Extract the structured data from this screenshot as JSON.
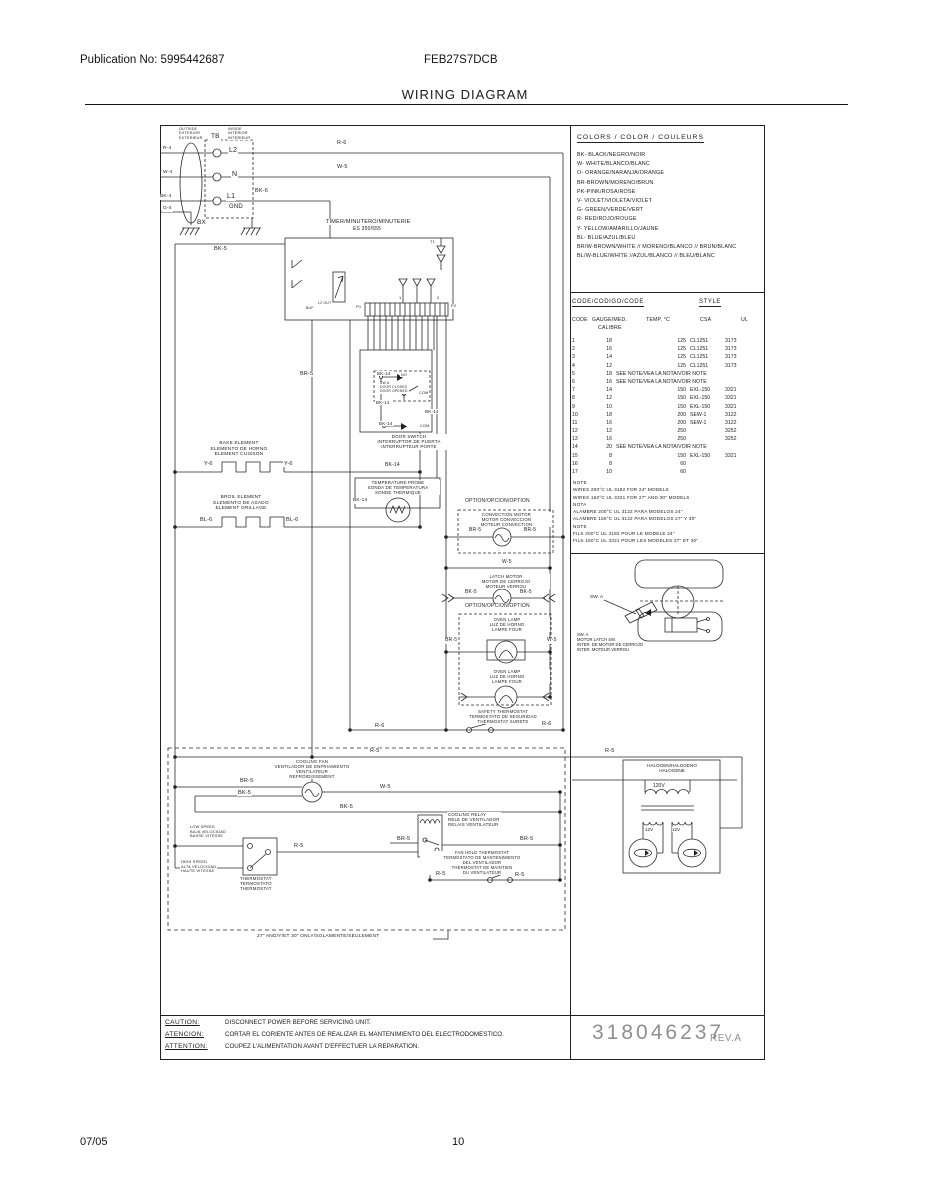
{
  "header": {
    "publication": "Publication No: 5995442687",
    "model": "FEB27S7DCB",
    "title": "WIRING DIAGRAM"
  },
  "footer": {
    "date": "07/05",
    "page": "10"
  },
  "right_panel": {
    "colors": {
      "title": "COLORS / COLOR / COULEURS",
      "items": [
        "BK- BLACK/NEGRO/NOIR",
        "W- WHITE/BLANCO/BLANC",
        "O- ORANGE/NARANJA/ORANGE",
        "BR-BROWN/MORENO/BRUN",
        "PK-PINK/ROSA/ROSE",
        "V- VIOLET/VIOLETA/VIOLET",
        "G- GREEN/VERDE/VERT",
        "R- RED/ROJO/ROUGE",
        "Y- YELLOW/AMARILLO/JAUNE",
        "BL- BLUE/AZUL/BLEU",
        "BR/W-BROWN/WHITE // MORENO/BLANCO // BRUN/BLANC",
        "BL/W-BLUE/WHITE //AZUL/BLANCO // BLEU/BLANC"
      ]
    },
    "code_table": {
      "title": "CODE/CODIGO/CODE",
      "style_header": "STYLE",
      "headers": [
        "CODE",
        "GAUGE/MED.",
        "TEMP. °C",
        "CSA",
        "UL"
      ],
      "subheader": "CALIBRE",
      "rows": [
        {
          "c": "1",
          "g": "18",
          "t": "125",
          "csa": "CL1251",
          "ul": "3173"
        },
        {
          "c": "2",
          "g": "16",
          "t": "125",
          "csa": "CL1251",
          "ul": "3173"
        },
        {
          "c": "3",
          "g": "14",
          "t": "125",
          "csa": "CL1251",
          "ul": "3173"
        },
        {
          "c": "4",
          "g": "12",
          "t": "125",
          "csa": "CL1251",
          "ul": "3173"
        },
        {
          "c": "5",
          "g": "18",
          "note": "SEE NOTE/VEA LA NOTA/VOIR NOTE"
        },
        {
          "c": "6",
          "g": "16",
          "note": "SEE NOTE/VEA LA NOTA/VOIR NOTE"
        },
        {
          "c": "7",
          "g": "14",
          "t": "150",
          "csa": "EXL-150",
          "ul": "3321"
        },
        {
          "c": "8",
          "g": "12",
          "t": "150",
          "csa": "EXL-150",
          "ul": "3321"
        },
        {
          "c": "9",
          "g": "10",
          "t": "150",
          "csa": "EXL-150",
          "ul": "3321"
        },
        {
          "c": "10",
          "g": "18",
          "t": "200",
          "csa": "SEW-1",
          "ul": "3122"
        },
        {
          "c": "11",
          "g": "16",
          "t": "200",
          "csa": "SEW-1",
          "ul": "3122"
        },
        {
          "c": "12",
          "g": "12",
          "t": "250",
          "ul": "3252"
        },
        {
          "c": "13",
          "g": "16",
          "t": "250",
          "ul": "3252"
        },
        {
          "c": "14",
          "g": "20",
          "note": "SEE NOTE/VEA LA NOTA/VOIR NOTE"
        },
        {
          "c": "15",
          "g": "8",
          "t": "150",
          "csa": "EXL-150",
          "ul": "3321"
        },
        {
          "c": "16",
          "g": "8",
          "t": "60"
        },
        {
          "c": "17",
          "g": "10",
          "t": "60"
        }
      ]
    },
    "notes": [
      "NOTE",
      "WIRES 200°C UL 3182 FOR 24\" MODELS",
      "WIRES 150°C UL 3321 FOR 27\" AND 30\" MODELS",
      "NOTA",
      "ALAMBRE 200°C UL 3122 PARA MODELOS 24\"",
      "ALAMBRE 150°C UL 3122 PARA MODELOS 27\" Y 30\"",
      "NOTE",
      "FILS 200°C UL 3182 POUR LE MODELE 24\"",
      "FILS 150°C UL 3321 POUR LES MODELES 27\" ET 30\""
    ],
    "latch": {
      "sw": "SW. A",
      "caption": "SW. A\nMOTOR LATCH SW.\nINTER. DE MOTOR DE CERROJO\nINTER. MOTEUR VERROU"
    },
    "halogen": {
      "title": "HALOGEN/HALOGENO\nHALOGENE",
      "primary": "120V",
      "sec1": "12V",
      "sec2": "12V"
    },
    "part_number": "318046237",
    "revision": "REV.A"
  },
  "caution": {
    "rows": [
      {
        "label": "CAUTION:",
        "text": "DISCONNECT POWER BEFORE SERVICING UNIT."
      },
      {
        "label": "ATENCION:",
        "text": "CORTAR EL CORIENTE ANTES DE REALIZAR EL MANTENIMIENTO DEL ELECTRODOMESTICO."
      },
      {
        "label": "ATTENTION:",
        "text": "COUPEZ L'ALIMENTATION AVANT D'EFFECTUER LA REPARATION."
      }
    ]
  },
  "schematic": {
    "labels": [
      {
        "text": "OUTSIDE\nEXTERIOR\nEXTERIEUR",
        "x": 178,
        "y": 127,
        "fs": 3.8
      },
      {
        "text": "INSIDE\nINTERIOR\nINTERIEUR",
        "x": 227,
        "y": 127,
        "fs": 3.8
      },
      {
        "text": "TB",
        "x": 210,
        "y": 133,
        "fs": 6.5
      },
      {
        "text": "L2",
        "x": 228,
        "y": 147,
        "fs": 7
      },
      {
        "text": "N",
        "x": 231,
        "y": 171,
        "fs": 7
      },
      {
        "text": "L1",
        "x": 226,
        "y": 193,
        "fs": 7
      },
      {
        "text": "GND",
        "x": 228,
        "y": 204,
        "fs": 6
      },
      {
        "text": "R-4",
        "x": 162,
        "y": 146,
        "fs": 4.8
      },
      {
        "text": "W-4",
        "x": 162,
        "y": 170,
        "fs": 4.8
      },
      {
        "text": "BK-4",
        "x": 159,
        "y": 194,
        "fs": 4.8
      },
      {
        "text": "G-4",
        "x": 162,
        "y": 206,
        "fs": 4.8
      },
      {
        "text": "BK-6",
        "x": 254,
        "y": 188,
        "fs": 5.5
      },
      {
        "text": "BX",
        "x": 196,
        "y": 219,
        "fs": 6.5
      },
      {
        "text": "R-6",
        "x": 336,
        "y": 140,
        "fs": 5.5
      },
      {
        "text": "W-5",
        "x": 336,
        "y": 164,
        "fs": 5.5
      },
      {
        "text": "BK-5",
        "x": 213,
        "y": 246,
        "fs": 5.5
      },
      {
        "text": "TIMER/MINUTERO/MINUTERIE",
        "x": 325,
        "y": 219,
        "fs": 5.5
      },
      {
        "text": "ES 350/555",
        "x": 352,
        "y": 227,
        "fs": 5
      },
      {
        "text": "T1",
        "x": 429,
        "y": 240,
        "fs": 4
      },
      {
        "text": "BUF",
        "x": 305,
        "y": 306,
        "fs": 3.5
      },
      {
        "text": "L2 OUT",
        "x": 317,
        "y": 301,
        "fs": 3.5
      },
      {
        "text": "P1",
        "x": 355,
        "y": 305,
        "fs": 4
      },
      {
        "text": "1",
        "x": 398,
        "y": 296,
        "fs": 4
      },
      {
        "text": "2",
        "x": 436,
        "y": 296,
        "fs": 4
      },
      {
        "text": "P2",
        "x": 450,
        "y": 304,
        "fs": 4
      },
      {
        "text": "BR-5",
        "x": 299,
        "y": 371,
        "fs": 5.5
      },
      {
        "text": "BK-14",
        "x": 376,
        "y": 371,
        "fs": 4.5
      },
      {
        "text": "NO",
        "x": 400,
        "y": 373,
        "fs": 3.8
      },
      {
        "text": "SW.A\nDOOR CLOSED\nDOOR OPENED",
        "x": 379,
        "y": 382,
        "fs": 3.4
      },
      {
        "text": "COM",
        "x": 418,
        "y": 391,
        "fs": 3.8
      },
      {
        "text": "BK-14",
        "x": 375,
        "y": 400,
        "fs": 4.5
      },
      {
        "text": "BK-14",
        "x": 424,
        "y": 409,
        "fs": 4.5
      },
      {
        "text": "BK-14",
        "x": 378,
        "y": 421,
        "fs": 4.5
      },
      {
        "text": "COM",
        "x": 419,
        "y": 424,
        "fs": 3.8
      },
      {
        "text": "DOOR SWITCH\nINTERRUPTOR DE PUERTA\nINTERRUPTEUR PORTE",
        "x": 358,
        "y": 434,
        "fs": 4.5,
        "w": 100,
        "align": "center"
      },
      {
        "text": "BK-14",
        "x": 384,
        "y": 463,
        "fs": 5
      },
      {
        "text": "TEMPERATURE PROBE\nSONDA DE TEMPERATURA\nSONDE THERMIQUE",
        "x": 356,
        "y": 480,
        "fs": 4.4,
        "w": 82,
        "align": "center"
      },
      {
        "text": "BK-14",
        "x": 352,
        "y": 498,
        "fs": 4.8
      },
      {
        "text": "BAKE ELEMENT\nELEMENTO DE HORNO\nELEMENT CUISSON",
        "x": 188,
        "y": 441,
        "fs": 4.8,
        "w": 100,
        "align": "center"
      },
      {
        "text": "Y-6",
        "x": 203,
        "y": 461,
        "fs": 5.5
      },
      {
        "text": "Y-6",
        "x": 283,
        "y": 461,
        "fs": 5.5
      },
      {
        "text": "BROIL ELEMENT\nELEMENTO DE ASADO\nELEMENT GRILLAGE",
        "x": 190,
        "y": 495,
        "fs": 4.8,
        "w": 100,
        "align": "center"
      },
      {
        "text": "BL-6",
        "x": 199,
        "y": 517,
        "fs": 5.5
      },
      {
        "text": "BL-6",
        "x": 285,
        "y": 517,
        "fs": 5.5
      },
      {
        "text": "OPTION/OPCION/OPTION",
        "x": 464,
        "y": 499,
        "fs": 5
      },
      {
        "text": "CONVECTION MOTOR\nMOTOR CONVECCION\nMOTEUR CONVECTION",
        "x": 461,
        "y": 512,
        "fs": 4.3,
        "w": 89,
        "align": "center"
      },
      {
        "text": "BR-5",
        "x": 468,
        "y": 528,
        "fs": 5
      },
      {
        "text": "BR-5",
        "x": 523,
        "y": 528,
        "fs": 5
      },
      {
        "text": "W-5",
        "x": 501,
        "y": 560,
        "fs": 5
      },
      {
        "text": "LATCH MOTOR\nMOTOR DE CERROJO\nMOTEUR VERROU",
        "x": 462,
        "y": 574,
        "fs": 4.3,
        "w": 86,
        "align": "center"
      },
      {
        "text": "BK-5",
        "x": 464,
        "y": 590,
        "fs": 5
      },
      {
        "text": "BK-5",
        "x": 519,
        "y": 590,
        "fs": 5
      },
      {
        "text": "OPTION/OPCION/OPTION",
        "x": 464,
        "y": 604,
        "fs": 5
      },
      {
        "text": "OVEN LAMP\nLUZ DE HORNO\nLAMPE FOUR",
        "x": 464,
        "y": 617,
        "fs": 4.3,
        "w": 84,
        "align": "center"
      },
      {
        "text": "BR-5",
        "x": 444,
        "y": 638,
        "fs": 5
      },
      {
        "text": "W-5",
        "x": 546,
        "y": 638,
        "fs": 5
      },
      {
        "text": "OVEN LAMP\nLUZ DE HORNO\nLAMPE FOUR",
        "x": 464,
        "y": 669,
        "fs": 4.3,
        "w": 84,
        "align": "center"
      },
      {
        "text": "SAFETY THERMOSTAT\nTERMOSTATO DE SEGURIDAD\nTHERMOSTAT SURETE",
        "x": 452,
        "y": 709,
        "fs": 4.3,
        "w": 100,
        "align": "center"
      },
      {
        "text": "R-6",
        "x": 374,
        "y": 723,
        "fs": 5.5
      },
      {
        "text": "R-6",
        "x": 541,
        "y": 721,
        "fs": 5.5
      },
      {
        "text": "R-5",
        "x": 369,
        "y": 748,
        "fs": 5.5
      },
      {
        "text": "R-5",
        "x": 604,
        "y": 748,
        "fs": 5.5
      },
      {
        "text": "COOLING FAN\nVENTILADOR DE ENFRIAMIENTO\nVENTILATEUR\nREFROIDISSEMENT",
        "x": 255,
        "y": 759,
        "fs": 4.4,
        "w": 112,
        "align": "center"
      },
      {
        "text": "BR-5",
        "x": 239,
        "y": 778,
        "fs": 5.5
      },
      {
        "text": "BK-5",
        "x": 237,
        "y": 790,
        "fs": 5.5
      },
      {
        "text": "W-5",
        "x": 379,
        "y": 784,
        "fs": 5.5
      },
      {
        "text": "BK-5",
        "x": 339,
        "y": 804,
        "fs": 5.5
      },
      {
        "text": "LOW SPEED\nBAJA VELOCIDAD\nBASSE VITESSE",
        "x": 189,
        "y": 825,
        "fs": 3.9
      },
      {
        "text": "HIGH SPEED\nALTA VELOCIDAD\nHAUTE VITESSE",
        "x": 180,
        "y": 860,
        "fs": 3.9
      },
      {
        "text": "THERMOSTAT\nTERMOSTATO\nTHERMOSTAT",
        "x": 239,
        "y": 876,
        "fs": 4.4
      },
      {
        "text": "R-5",
        "x": 293,
        "y": 843,
        "fs": 5.5
      },
      {
        "text": "COOLING RELAY\nRELE DE VENTILADOR\nRELAIS VENTILATEUR",
        "x": 447,
        "y": 812,
        "fs": 4.4
      },
      {
        "text": "BR-5",
        "x": 396,
        "y": 836,
        "fs": 5.5
      },
      {
        "text": "BR-5",
        "x": 519,
        "y": 836,
        "fs": 5.5
      },
      {
        "text": "FAN HOLD THERMOSTAT\nTERMOSTATO DE MANTENIMIENTO\nDEL VENTILADOR\nTHERMOSTAT DE MAINTIEN\nDU VENTILATEUR",
        "x": 420,
        "y": 851,
        "fs": 4.2,
        "w": 122,
        "align": "center"
      },
      {
        "text": "R-5",
        "x": 435,
        "y": 871,
        "fs": 5.5
      },
      {
        "text": "R-5",
        "x": 514,
        "y": 872,
        "fs": 5.5
      },
      {
        "text": "27\" AND/Y/ET 30\" ONLY/SOLAMENTE/SEULEMENT",
        "x": 256,
        "y": 934,
        "fs": 4.8
      }
    ]
  }
}
